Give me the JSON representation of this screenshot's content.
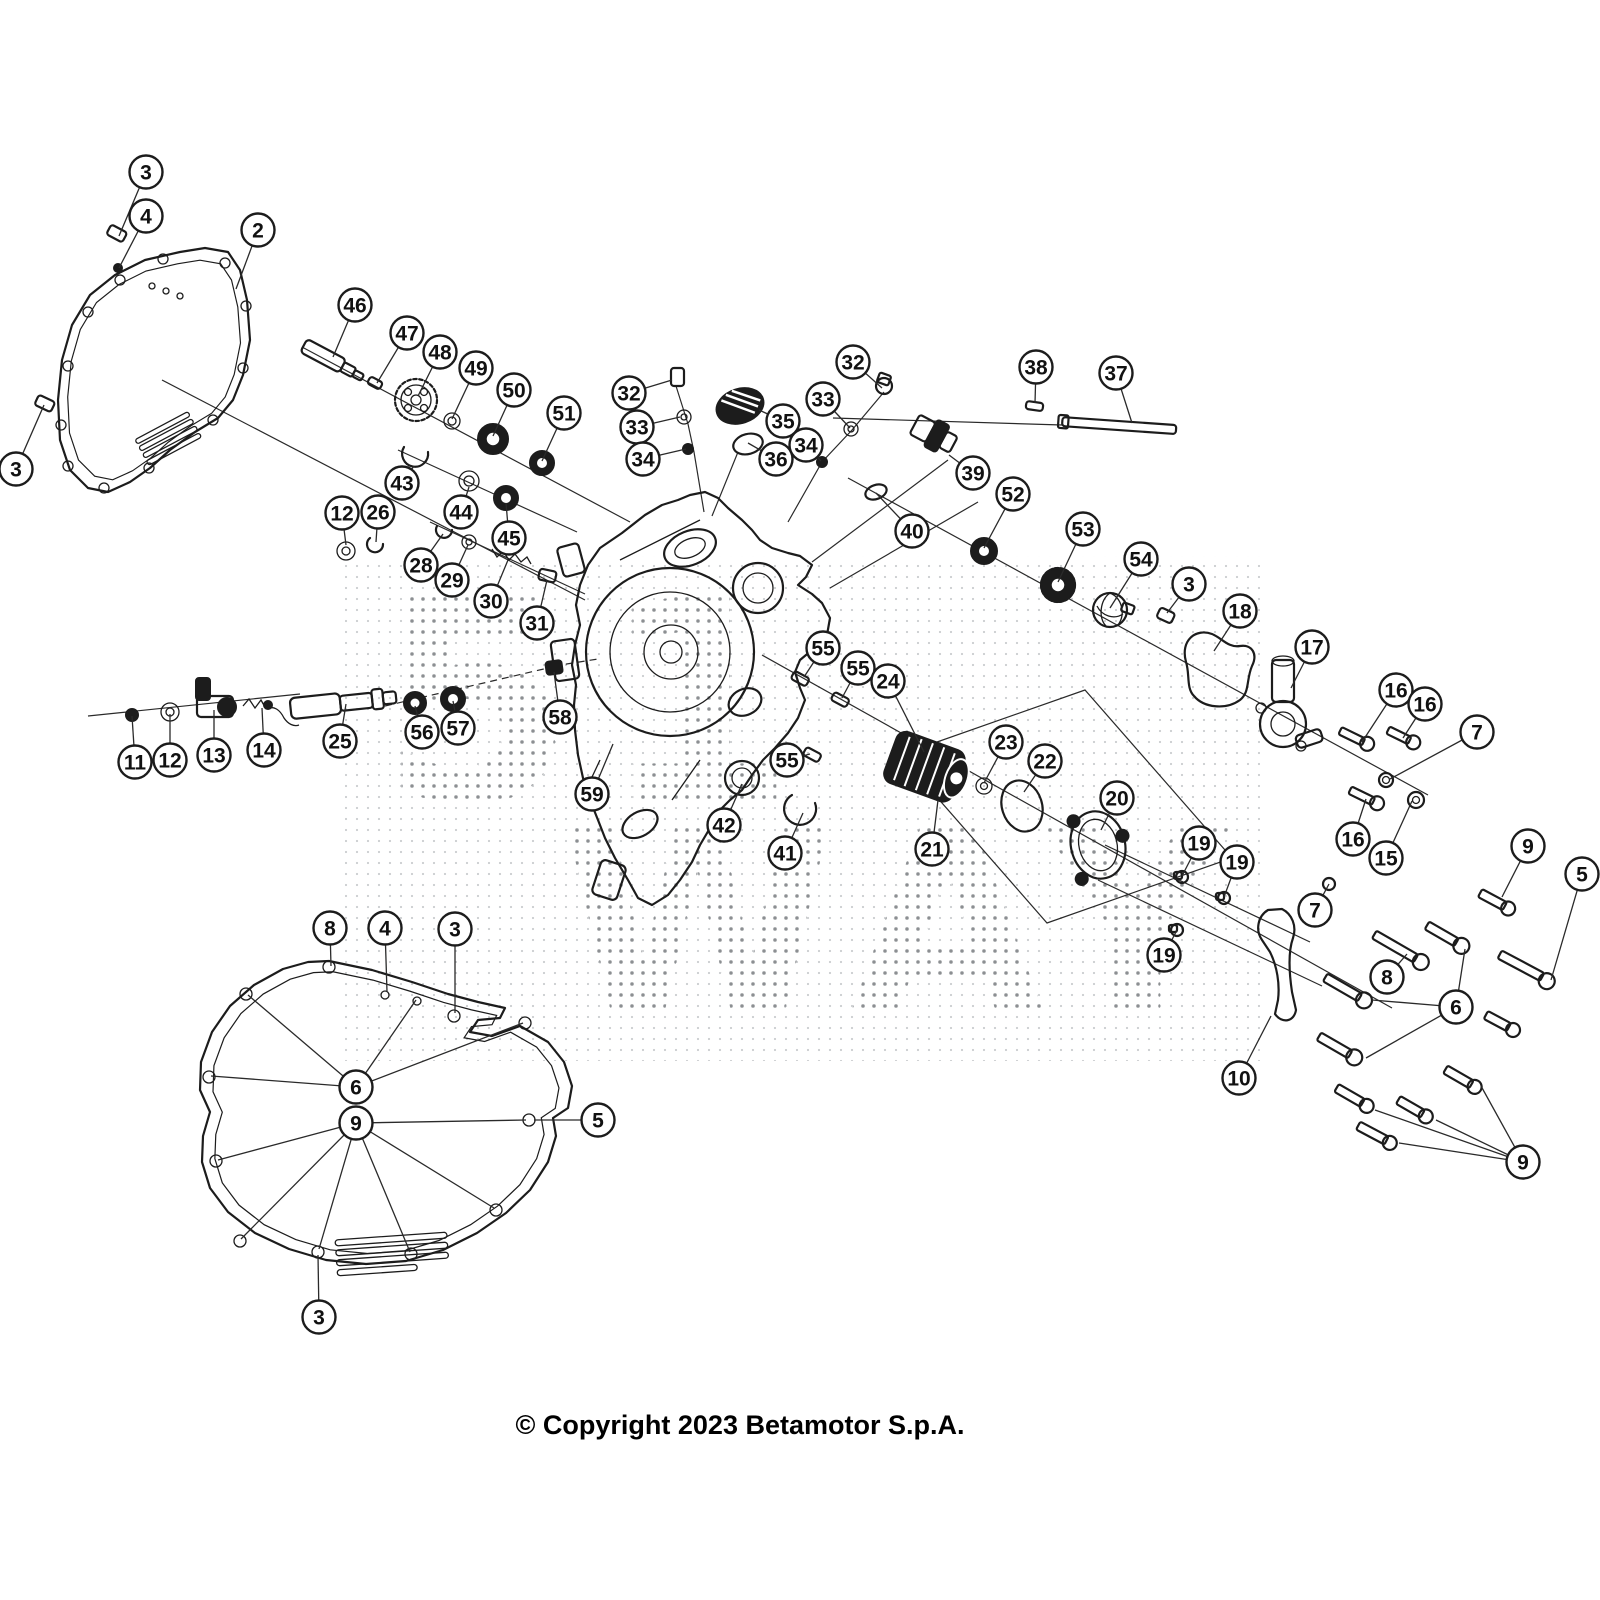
{
  "copyright": "© Copyright 2023 Betamotor S.p.A.",
  "watermark": {
    "rows": [
      "51",
      "WAY"
    ],
    "style": "halftone-dots",
    "dot_color": "#8a8f94"
  },
  "diagram": {
    "type": "exploded-parts-diagram",
    "subject": "engine clutch cover assembly",
    "line_color": "#1c1c1c",
    "background": "#ffffff"
  },
  "callouts": [
    {
      "n": "3",
      "x": 146,
      "y": 172,
      "l": [
        [
          119,
          236
        ]
      ]
    },
    {
      "n": "4",
      "x": 146,
      "y": 216,
      "l": [
        [
          119,
          268
        ]
      ]
    },
    {
      "n": "2",
      "x": 258,
      "y": 230,
      "l": [
        [
          236,
          289
        ]
      ]
    },
    {
      "n": "3",
      "x": 16,
      "y": 469,
      "l": [
        [
          44,
          405
        ]
      ]
    },
    {
      "n": "46",
      "x": 355,
      "y": 305,
      "l": [
        [
          333,
          357
        ]
      ]
    },
    {
      "n": "47",
      "x": 407,
      "y": 333,
      "l": [
        [
          377,
          383
        ]
      ]
    },
    {
      "n": "48",
      "x": 440,
      "y": 352,
      "l": [
        [
          418,
          396
        ]
      ]
    },
    {
      "n": "49",
      "x": 476,
      "y": 368,
      "l": [
        [
          452,
          419
        ]
      ]
    },
    {
      "n": "50",
      "x": 514,
      "y": 390,
      "l": [
        [
          493,
          436
        ]
      ]
    },
    {
      "n": "51",
      "x": 564,
      "y": 413,
      "l": [
        [
          542,
          461
        ]
      ]
    },
    {
      "n": "43",
      "x": 402,
      "y": 483,
      "l": [
        [
          414,
          466
        ]
      ]
    },
    {
      "n": "44",
      "x": 461,
      "y": 512,
      "l": [
        [
          469,
          487
        ]
      ]
    },
    {
      "n": "45",
      "x": 509,
      "y": 538,
      "l": [
        [
          506,
          503
        ]
      ]
    },
    {
      "n": "28",
      "x": 421,
      "y": 565,
      "l": [
        [
          443,
          534
        ]
      ]
    },
    {
      "n": "29",
      "x": 452,
      "y": 580,
      "l": [
        [
          468,
          545
        ]
      ]
    },
    {
      "n": "30",
      "x": 491,
      "y": 601,
      "l": [
        [
          508,
          560
        ]
      ]
    },
    {
      "n": "31",
      "x": 537,
      "y": 623,
      "l": [
        [
          547,
          580
        ]
      ]
    },
    {
      "n": "12",
      "x": 342,
      "y": 513,
      "l": [
        [
          346,
          545
        ]
      ]
    },
    {
      "n": "26",
      "x": 378,
      "y": 512,
      "l": [
        [
          376,
          542
        ]
      ]
    },
    {
      "n": "32",
      "x": 629,
      "y": 393,
      "l": [
        [
          672,
          380
        ]
      ]
    },
    {
      "n": "33",
      "x": 637,
      "y": 427,
      "l": [
        [
          680,
          417
        ]
      ]
    },
    {
      "n": "34",
      "x": 643,
      "y": 459,
      "l": [
        [
          686,
          449
        ]
      ]
    },
    {
      "n": "35",
      "x": 783,
      "y": 421,
      "l": [
        [
          759,
          410
        ]
      ]
    },
    {
      "n": "36",
      "x": 776,
      "y": 459,
      "l": [
        [
          748,
          443
        ]
      ]
    },
    {
      "n": "32",
      "x": 853,
      "y": 362,
      "l": [
        [
          882,
          388
        ]
      ]
    },
    {
      "n": "33",
      "x": 823,
      "y": 399,
      "l": [
        [
          850,
          428
        ]
      ]
    },
    {
      "n": "34",
      "x": 806,
      "y": 445,
      "l": [
        [
          821,
          461
        ]
      ]
    },
    {
      "n": "38",
      "x": 1036,
      "y": 367,
      "l": [
        [
          1035,
          403
        ]
      ]
    },
    {
      "n": "37",
      "x": 1116,
      "y": 373,
      "l": [
        [
          1132,
          423
        ]
      ]
    },
    {
      "n": "39",
      "x": 973,
      "y": 473,
      "l": [
        [
          949,
          455
        ]
      ]
    },
    {
      "n": "40",
      "x": 912,
      "y": 531,
      "l": [
        [
          876,
          493
        ]
      ]
    },
    {
      "n": "52",
      "x": 1013,
      "y": 494,
      "l": [
        [
          984,
          548
        ]
      ]
    },
    {
      "n": "53",
      "x": 1083,
      "y": 529,
      "l": [
        [
          1058,
          582
        ]
      ]
    },
    {
      "n": "54",
      "x": 1141,
      "y": 559,
      "l": [
        [
          1110,
          608
        ]
      ]
    },
    {
      "n": "3",
      "x": 1189,
      "y": 584,
      "l": [
        [
          1167,
          613
        ]
      ]
    },
    {
      "n": "18",
      "x": 1240,
      "y": 611,
      "l": [
        [
          1214,
          651
        ]
      ]
    },
    {
      "n": "17",
      "x": 1312,
      "y": 647,
      "l": [
        [
          1291,
          688
        ]
      ]
    },
    {
      "n": "55",
      "x": 823,
      "y": 648,
      "l": [
        [
          804,
          677
        ]
      ]
    },
    {
      "n": "55",
      "x": 858,
      "y": 668,
      "l": [
        [
          842,
          698
        ]
      ]
    },
    {
      "n": "24",
      "x": 888,
      "y": 681,
      "l": [
        [
          924,
          752
        ]
      ]
    },
    {
      "n": "55",
      "x": 787,
      "y": 760,
      "l": [
        [
          810,
          754
        ]
      ]
    },
    {
      "n": "59",
      "x": 592,
      "y": 794,
      "l": [
        [
          613,
          744
        ]
      ]
    },
    {
      "n": "42",
      "x": 724,
      "y": 825,
      "l": [
        [
          742,
          784
        ]
      ]
    },
    {
      "n": "41",
      "x": 785,
      "y": 853,
      "l": [
        [
          803,
          813
        ]
      ]
    },
    {
      "n": "21",
      "x": 932,
      "y": 849,
      "l": [
        [
          938,
          800
        ]
      ]
    },
    {
      "n": "23",
      "x": 1006,
      "y": 742,
      "l": [
        [
          984,
          783
        ]
      ]
    },
    {
      "n": "22",
      "x": 1045,
      "y": 761,
      "l": [
        [
          1024,
          792
        ]
      ]
    },
    {
      "n": "20",
      "x": 1117,
      "y": 798,
      "l": [
        [
          1101,
          830
        ]
      ]
    },
    {
      "n": "19",
      "x": 1199,
      "y": 843,
      "l": [
        [
          1182,
          876
        ]
      ]
    },
    {
      "n": "19",
      "x": 1237,
      "y": 862,
      "l": [
        [
          1224,
          897
        ]
      ]
    },
    {
      "n": "19",
      "x": 1164,
      "y": 955,
      "l": [
        [
          1177,
          930
        ]
      ]
    },
    {
      "n": "56",
      "x": 422,
      "y": 732,
      "l": [
        [
          415,
          706
        ]
      ]
    },
    {
      "n": "57",
      "x": 458,
      "y": 728,
      "l": [
        [
          453,
          701
        ]
      ]
    },
    {
      "n": "58",
      "x": 560,
      "y": 717,
      "l": [
        [
          554,
          672
        ]
      ]
    },
    {
      "n": "25",
      "x": 340,
      "y": 741,
      "l": [
        [
          346,
          704
        ]
      ]
    },
    {
      "n": "14",
      "x": 264,
      "y": 750,
      "l": [
        [
          262,
          708
        ]
      ]
    },
    {
      "n": "13",
      "x": 214,
      "y": 755,
      "l": [
        [
          214,
          710
        ]
      ]
    },
    {
      "n": "12",
      "x": 170,
      "y": 760,
      "l": [
        [
          170,
          714
        ]
      ]
    },
    {
      "n": "11",
      "x": 135,
      "y": 762,
      "l": [
        [
          132,
          716
        ]
      ]
    },
    {
      "n": "16",
      "x": 1396,
      "y": 690,
      "l": [
        [
          1362,
          742
        ]
      ]
    },
    {
      "n": "16",
      "x": 1425,
      "y": 704,
      "l": [
        [
          1403,
          738
        ]
      ]
    },
    {
      "n": "7",
      "x": 1477,
      "y": 732,
      "l": [
        [
          1390,
          779
        ]
      ]
    },
    {
      "n": "16",
      "x": 1353,
      "y": 839,
      "l": [
        [
          1366,
          799
        ]
      ]
    },
    {
      "n": "15",
      "x": 1386,
      "y": 858,
      "l": [
        [
          1412,
          801
        ]
      ]
    },
    {
      "n": "7",
      "x": 1315,
      "y": 910,
      "l": [
        [
          1329,
          884
        ]
      ]
    },
    {
      "n": "10",
      "x": 1239,
      "y": 1078,
      "l": [
        [
          1271,
          1016
        ]
      ]
    },
    {
      "n": "9",
      "x": 1528,
      "y": 846,
      "l": [
        [
          1502,
          897
        ]
      ]
    },
    {
      "n": "5",
      "x": 1582,
      "y": 874,
      "l": [
        [
          1551,
          980
        ]
      ]
    },
    {
      "n": "8",
      "x": 1387,
      "y": 977,
      "l": [
        [
          1407,
          954
        ]
      ]
    },
    {
      "n": "6",
      "x": 1456,
      "y": 1007,
      "l": [
        [
          1372,
          1000
        ],
        [
          1465,
          949
        ],
        [
          1366,
          1058
        ]
      ]
    },
    {
      "n": "9",
      "x": 1523,
      "y": 1162,
      "l": [
        [
          1481,
          1086
        ],
        [
          1436,
          1120
        ],
        [
          1399,
          1143
        ],
        [
          1375,
          1110
        ]
      ]
    },
    {
      "n": "8",
      "x": 330,
      "y": 928,
      "l": [
        [
          331,
          966
        ]
      ]
    },
    {
      "n": "4",
      "x": 385,
      "y": 928,
      "l": [
        [
          387,
          992
        ]
      ]
    },
    {
      "n": "3",
      "x": 455,
      "y": 929,
      "l": [
        [
          455,
          1013
        ]
      ]
    },
    {
      "n": "6",
      "x": 356,
      "y": 1087,
      "l": [
        [
          248,
          995
        ],
        [
          416,
          1000
        ],
        [
          211,
          1076
        ],
        [
          523,
          1023
        ]
      ]
    },
    {
      "n": "9",
      "x": 356,
      "y": 1123,
      "l": [
        [
          218,
          1160
        ],
        [
          241,
          1239
        ],
        [
          319,
          1249
        ],
        [
          410,
          1252
        ],
        [
          494,
          1208
        ],
        [
          526,
          1120
        ]
      ]
    },
    {
      "n": "5",
      "x": 598,
      "y": 1120,
      "l": [
        [
          534,
          1120
        ]
      ]
    },
    {
      "n": "3",
      "x": 319,
      "y": 1317,
      "l": [
        [
          318,
          1255
        ]
      ]
    }
  ]
}
